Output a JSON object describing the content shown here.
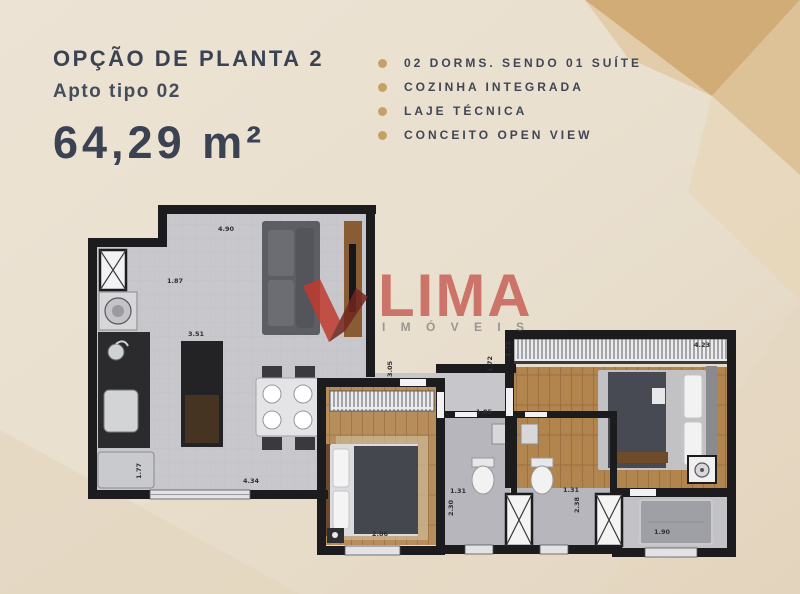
{
  "header": {
    "title": "OPÇÃO DE PLANTA 2",
    "subtitle": "Apto tipo 02",
    "area": "64,29 m²"
  },
  "features": {
    "items": [
      {
        "label": "02 DORMS. SENDO 01 SUÍTE"
      },
      {
        "label": "COZINHA INTEGRADA"
      },
      {
        "label": "LAJE TÉCNICA"
      },
      {
        "label": "CONCEITO OPEN VIEW"
      }
    ]
  },
  "watermark": {
    "brand": "LIMA",
    "sub": "I M Ó V E I S"
  },
  "plan": {
    "dimensions": [
      {
        "v": "4.90"
      },
      {
        "v": "1.87"
      },
      {
        "v": "3.51"
      },
      {
        "v": "4.34"
      },
      {
        "v": "1.77"
      },
      {
        "v": "2.86"
      },
      {
        "v": "3.05"
      },
      {
        "v": "1.85"
      },
      {
        "v": "1.72"
      },
      {
        "v": "1.31"
      },
      {
        "v": "2.30"
      },
      {
        "v": "1.31"
      },
      {
        "v": "2.38"
      },
      {
        "v": "1.72"
      },
      {
        "v": "4.23"
      },
      {
        "v": "1.90"
      }
    ]
  },
  "colors": {
    "title_text": "#3b4252",
    "bullet_gold": "#c5a167",
    "watermark_red": "#c4574d",
    "wall_black": "#1c1c1e",
    "wood_floor": "#b78e5b",
    "tile_floor": "#c8c8cc",
    "accent_tan": "#d2ac77"
  }
}
